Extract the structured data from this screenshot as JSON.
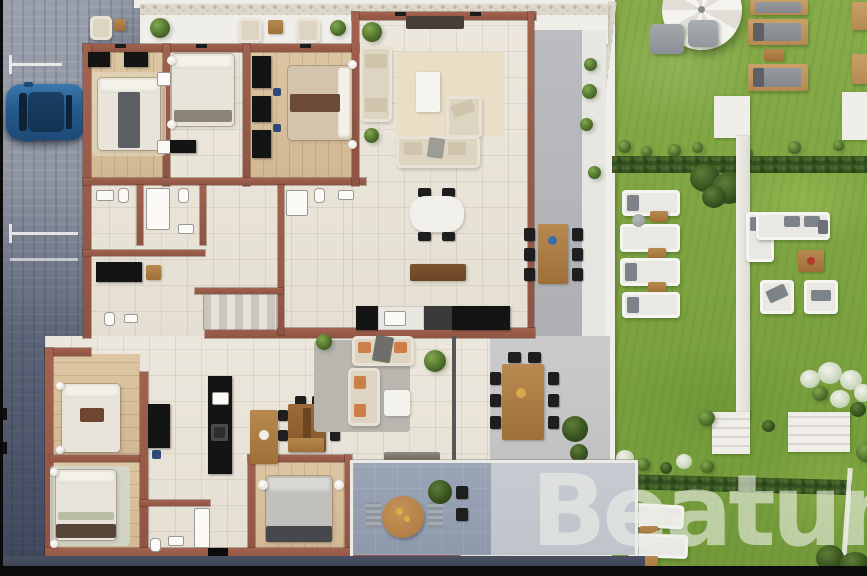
{
  "watermark": {
    "text": "Beatum doo",
    "color": "rgba(236,239,231,0.62)"
  },
  "palette": {
    "wall_brown": "#9a5c4b",
    "floor_cream": "#eae5da",
    "floor_wood": "#d9c3a0",
    "road_gray": "#8a909c",
    "lawn_green": "#81a745",
    "hedge_green": "#36511f",
    "terrace_gray": "#b6b7ba",
    "balcony_blue": "#97a2b3",
    "car_blue": "#2c6093",
    "furniture_cream": "#ddd5c2",
    "outdoor_wood": "#a8763f",
    "accent_orange": "#cd7f4a",
    "black_trim": "#0b0b0b",
    "white_surface": "#efeee9"
  }
}
